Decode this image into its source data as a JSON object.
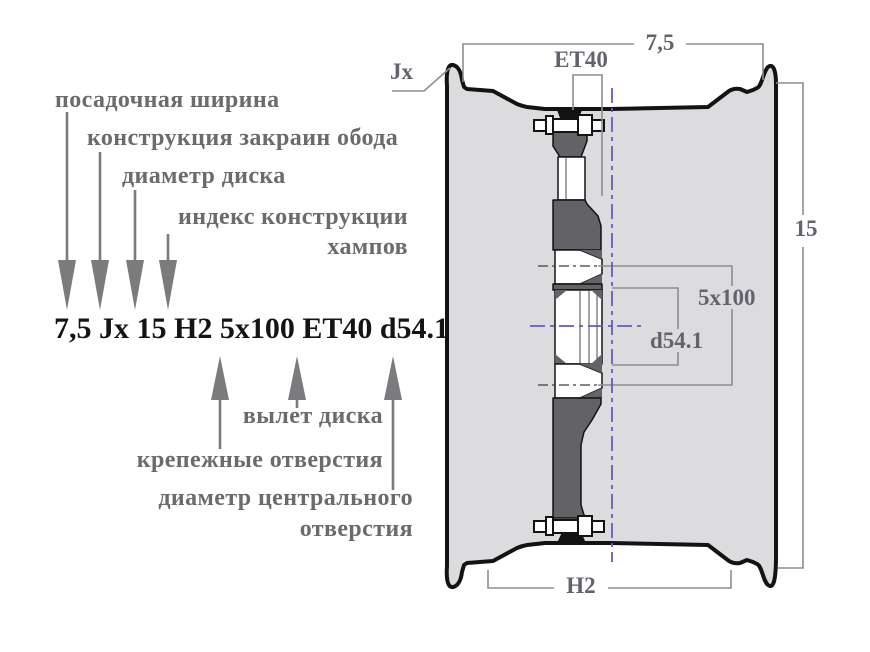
{
  "legend": {
    "top_labels": [
      "посадочная ширина",
      "конструкция закраин обода",
      "диаметр диска",
      "индекс конструкции",
      "хампов"
    ],
    "marking": "7,5 Jx 15 H2 5x100 ET40 d54.1",
    "bottom_labels": [
      "вылет диска",
      "крепежные отверстия",
      "диаметр центрального",
      "отверстия"
    ]
  },
  "drawing": {
    "rim_width": "7,5",
    "offset": "ET40",
    "flange_type": "Jx",
    "diameter": "15",
    "bolt_pattern": "5x100",
    "center_bore": "d54.1",
    "hump": "H2"
  },
  "colors": {
    "label_gray": "#6b6b6e",
    "arrow_gray": "#7b7b7e",
    "marking_black": "#141414",
    "outline_black": "#131313",
    "rim_fill": "#dcdcde",
    "disc_fill": "#636367",
    "dim_line_gray": "#8d8d92",
    "dim_text_gray": "#63636d",
    "centerline_blue": "#5e5ec4"
  }
}
